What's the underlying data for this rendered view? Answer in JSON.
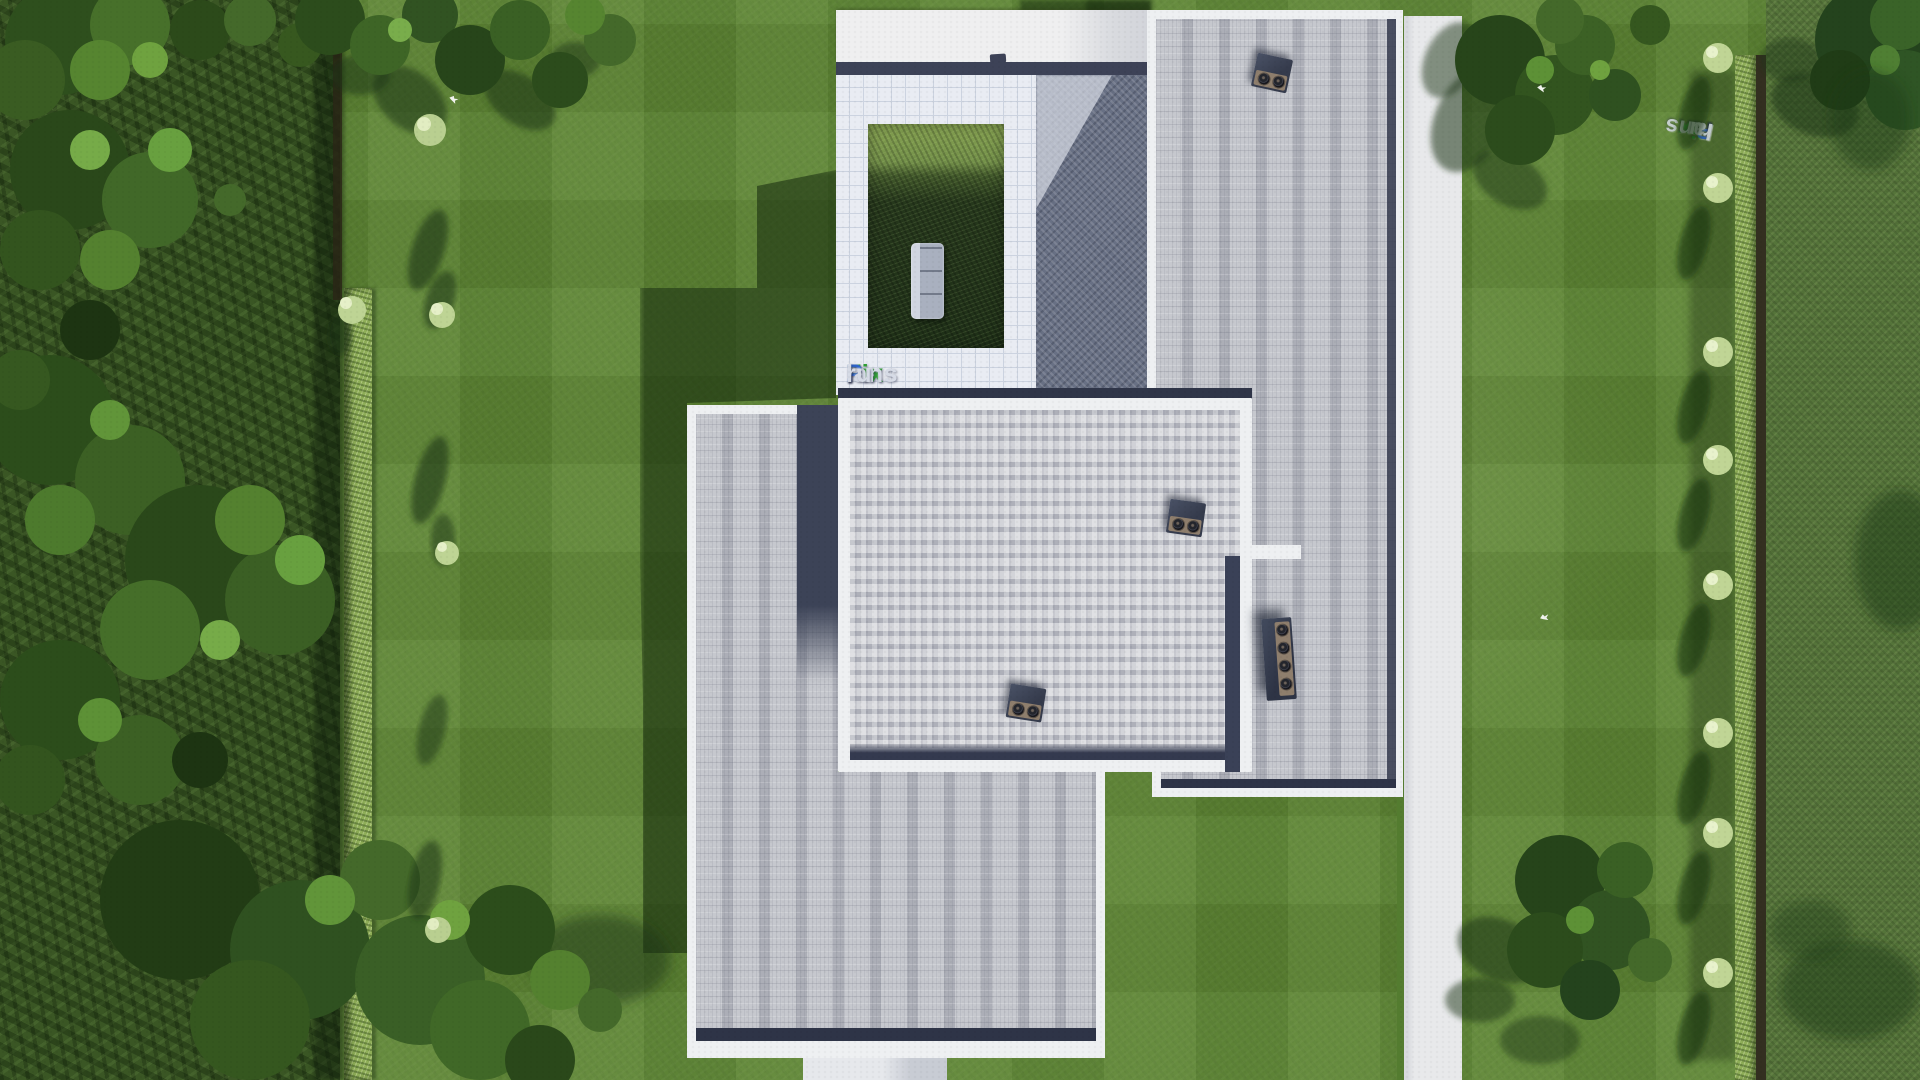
{
  "image": {
    "type": "3d-aerial-architectural-render",
    "subject": "Top-down bird's-eye view of a modern flat-roof house with gray shingle roofs, white roof borders, inner garden courtyard with sofa, lawns, hedges, trees and white walkways",
    "width_px": 1920,
    "height_px": 1080
  },
  "watermark": {
    "text": "FixPlans.ru",
    "part_fix": "Fix",
    "part_p": "P",
    "part_lans": "lans",
    "part_dot": ".",
    "part_ru": "ru",
    "color_green": "#2f9e33",
    "color_blue": "#2e63c9",
    "color_silver": "#d6dbe6",
    "instances": [
      "normal at bottom-left of white tiled terrace",
      "rotated 180 degrees on upper terrace tiles"
    ]
  },
  "palette": {
    "lawn": "#5c8433",
    "outer_lawn": "#55743a",
    "forest": "#3a5624",
    "hedge": "#8fae58",
    "shadow_green": "#16300f",
    "roof_tile_light": "#d4d5da",
    "roof_tile_mid": "#abadb7",
    "roof_border_white": "#eef0f2",
    "eave_navy": "#2e3447",
    "terrace_tile": "#e9ecf3",
    "paving_shadowed": "#687084",
    "paving_lit": "#b9bdc8",
    "courtyard_grass_lit": "#86a251",
    "courtyard_grass_shade": "#1f3018",
    "sofa_gray": "#a9b0bf",
    "ac_body_navy": "#353b4c",
    "ac_panel_tan": "#8e7e6d"
  },
  "scene_objects": {
    "roof_sections": 3,
    "ac_units": 4,
    "walkways": 2,
    "hedge_rows": 2,
    "courtyard_sofa": 1,
    "white_birds_on_lawn": 3
  }
}
